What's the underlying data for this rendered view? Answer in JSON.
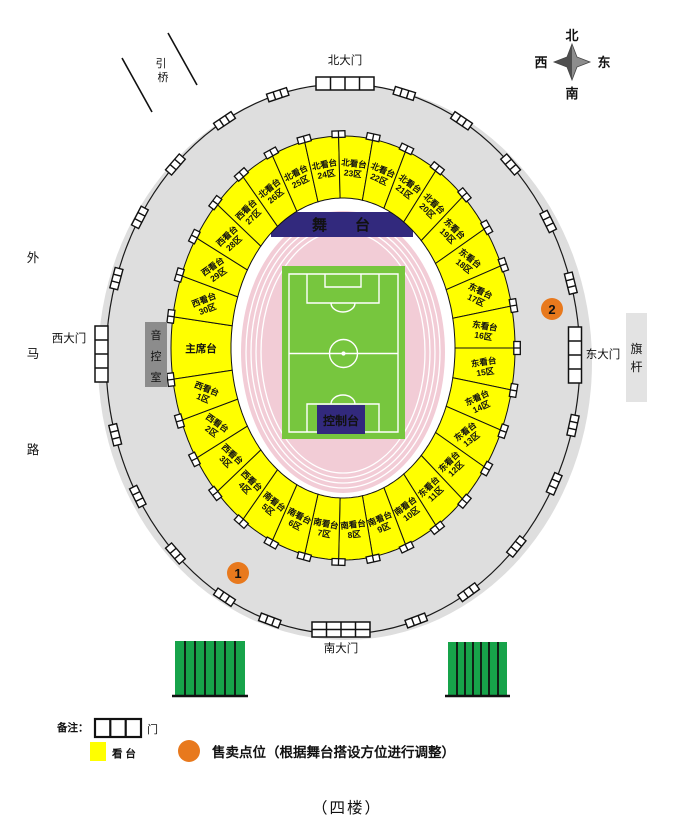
{
  "page": {
    "title": "（四楼）"
  },
  "compass": {
    "n": "北",
    "s": "南",
    "e": "东",
    "w": "西"
  },
  "outer": {
    "bridge": [
      "引",
      "桥"
    ],
    "road": [
      "外",
      "马",
      "路"
    ],
    "gates": {
      "north": "北大门",
      "south": "南大门",
      "west": "西大门",
      "east": "东大门"
    },
    "flagpole": [
      "旗",
      "杆"
    ]
  },
  "infield": {
    "stage": "舞台",
    "control": "控制台",
    "audio_room": [
      "音",
      "控",
      "室"
    ]
  },
  "sections": [
    {
      "line1": "主席台",
      "line2": ""
    },
    {
      "line1": "西看台",
      "line2": "30区"
    },
    {
      "line1": "西看台",
      "line2": "29区"
    },
    {
      "line1": "西看台",
      "line2": "28区"
    },
    {
      "line1": "西看台",
      "line2": "27区"
    },
    {
      "line1": "北看台",
      "line2": "26区"
    },
    {
      "line1": "北看台",
      "line2": "25区"
    },
    {
      "line1": "北看台",
      "line2": "24区"
    },
    {
      "line1": "北看台",
      "line2": "23区"
    },
    {
      "line1": "北看台",
      "line2": "22区"
    },
    {
      "line1": "北看台",
      "line2": "21区"
    },
    {
      "line1": "北看台",
      "line2": "20区"
    },
    {
      "line1": "东看台",
      "line2": "19区"
    },
    {
      "line1": "东看台",
      "line2": "18区"
    },
    {
      "line1": "东看台",
      "line2": "17区"
    },
    {
      "line1": "东看台",
      "line2": "16区"
    },
    {
      "line1": "东看台",
      "line2": "15区"
    },
    {
      "line1": "东看台",
      "line2": "14区"
    },
    {
      "line1": "东看台",
      "line2": "13区"
    },
    {
      "line1": "东看台",
      "line2": "12区"
    },
    {
      "line1": "东看台",
      "line2": "11区"
    },
    {
      "line1": "南看台",
      "line2": "10区"
    },
    {
      "line1": "南看台",
      "line2": "9区"
    },
    {
      "line1": "南看台",
      "line2": "8区"
    },
    {
      "line1": "南看台",
      "line2": "7区"
    },
    {
      "line1": "南看台",
      "line2": "6区"
    },
    {
      "line1": "南看台",
      "line2": "5区"
    },
    {
      "line1": "西看台",
      "line2": "4区"
    },
    {
      "line1": "西看台",
      "line2": "3区"
    },
    {
      "line1": "西看台",
      "line2": "2区"
    },
    {
      "line1": "西看台",
      "line2": "1区"
    }
  ],
  "selling_points": [
    {
      "label": "1"
    },
    {
      "label": "2"
    }
  ],
  "legend": {
    "note": "备注：",
    "gate": "门",
    "stand": "看  台",
    "selling": "售卖点位（根据舞台搭设方位进行调整）"
  },
  "colors": {
    "ground_gray": "#dedede",
    "yellow": "#ffff00",
    "track_pink": "#f2ccd6",
    "field_green": "#77c63e",
    "navy": "#32297d",
    "orange": "#e8791d",
    "structure_green": "#17a34a",
    "audio_gray": "#8c8c8c",
    "flag_gray": "#e3e3e3"
  }
}
